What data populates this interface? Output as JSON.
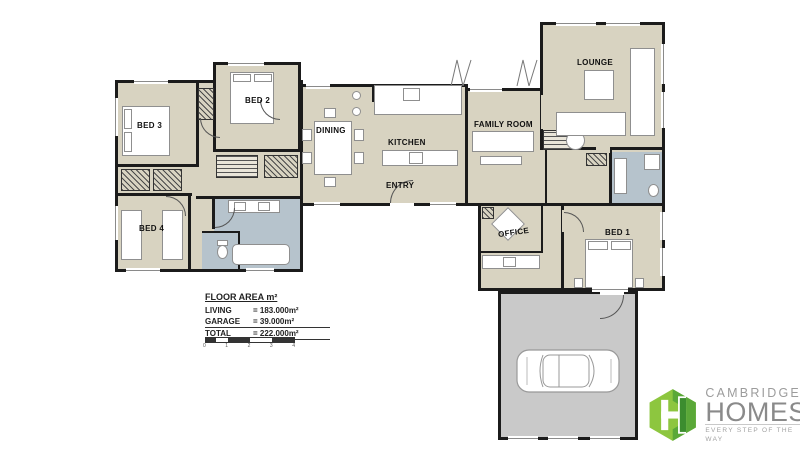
{
  "rooms": {
    "bed3": "BED 3",
    "bed2": "BED 2",
    "bed4": "BED 4",
    "dining": "DINING",
    "kitchen": "KITCHEN",
    "entry": "ENTRY",
    "family": "FAMILY ROOM",
    "lounge": "LOUNGE",
    "office": "OFFICE",
    "bed1": "BED 1"
  },
  "area_table": {
    "title": "FLOOR AREA m²",
    "rows": [
      {
        "label": "LIVING",
        "value": "= 183.000m²"
      },
      {
        "label": "GARAGE",
        "value": "=  39.000m²"
      },
      {
        "label": "TOTAL",
        "value": "= 222.000m²"
      }
    ]
  },
  "scale_bar": {
    "labels": [
      "0",
      "1",
      "2",
      "3",
      "4"
    ]
  },
  "logo": {
    "name": "CAMBRIDGE",
    "word": "HOMES",
    "tagline": "EVERY STEP OF THE WAY",
    "green_light": "#8dc63f",
    "green_dark": "#4a9b35",
    "text_gray": "#8a8a8a"
  },
  "colors": {
    "floor": "#d8d3c1",
    "wet_area": "#b6c3cc",
    "garage": "#c9c9c9",
    "wall": "#1b1b1b"
  }
}
